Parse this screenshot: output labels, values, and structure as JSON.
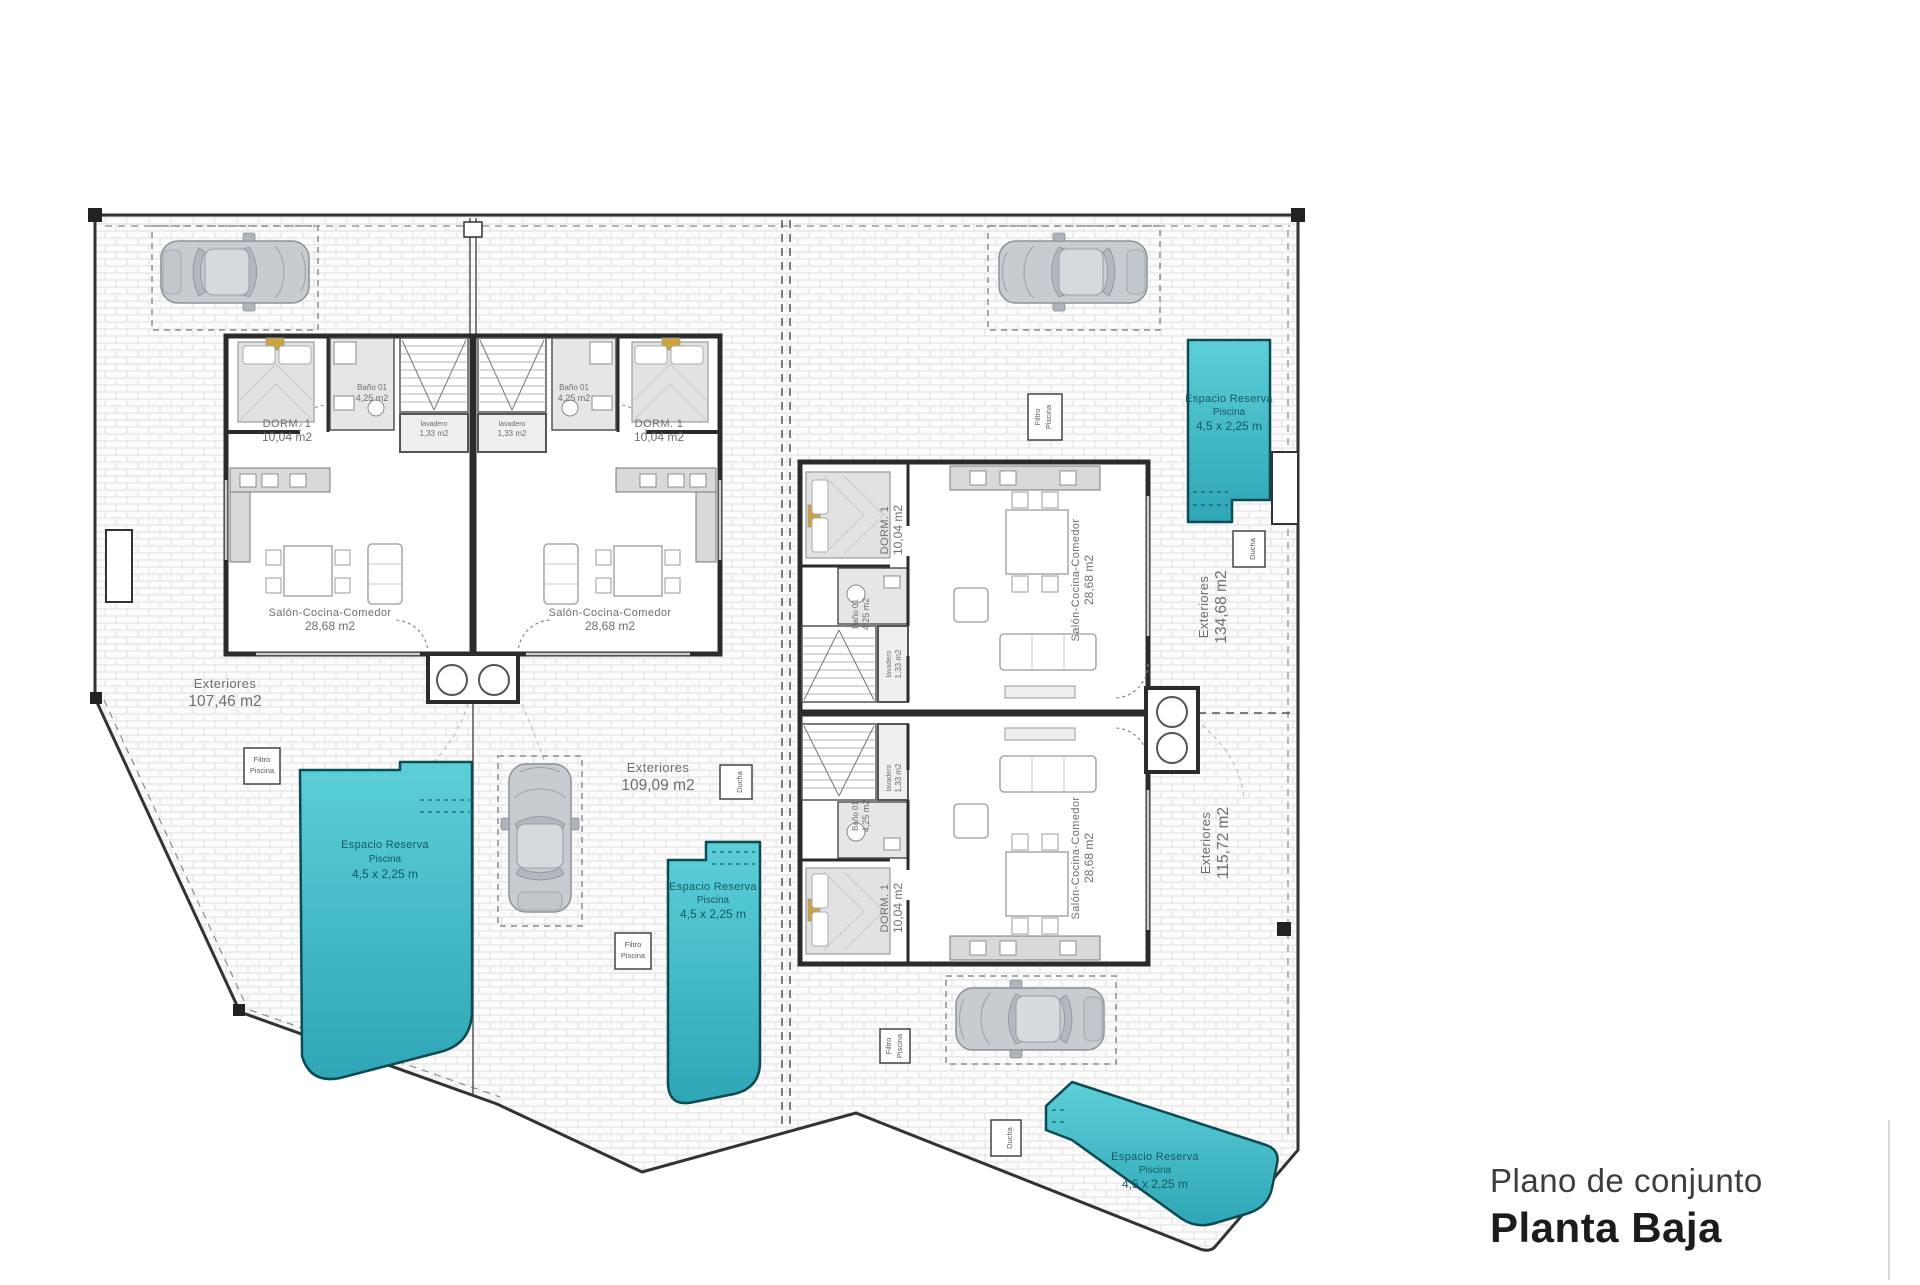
{
  "title": {
    "subtitle": "Plano de conjunto",
    "main": "Planta Baja"
  },
  "labels": {
    "dorm": {
      "name": "DORM. 1",
      "area": "10,04 m2"
    },
    "bano": {
      "name": "Baño 01",
      "area": "4,25 m2"
    },
    "lavadero": {
      "name": "lavadero",
      "area": "1,33 m2"
    },
    "salon": {
      "name": "Salón-Cocina-Comedor",
      "area": "28,68 m2"
    },
    "pool": {
      "line1": "Espacio Reserva",
      "line2": "Piscina",
      "line3": "4,5 x 2,25 m"
    },
    "filtro": {
      "line1": "Filtro",
      "line2": "Piscina"
    },
    "ducha": "Ducha"
  },
  "exteriors": [
    {
      "name": "Exteriores",
      "area": "107,46 m2"
    },
    {
      "name": "Exteriores",
      "area": "109,09 m2"
    },
    {
      "name": "Exteriores",
      "area": "134,68 m2"
    },
    {
      "name": "Exteriores",
      "area": "115,72 m2"
    }
  ],
  "colors": {
    "pool_fill": "#4cc5cf",
    "pool_fill_dark": "#2fa6b6",
    "pool_stroke": "#0d4a52",
    "pool_text": "#155a64",
    "wall": "#2b2b2b",
    "label_text": "#6e6e6e",
    "title_sub": "#3d3d3d",
    "title_main": "#1c1c1c",
    "gold": "#c9a43f"
  }
}
